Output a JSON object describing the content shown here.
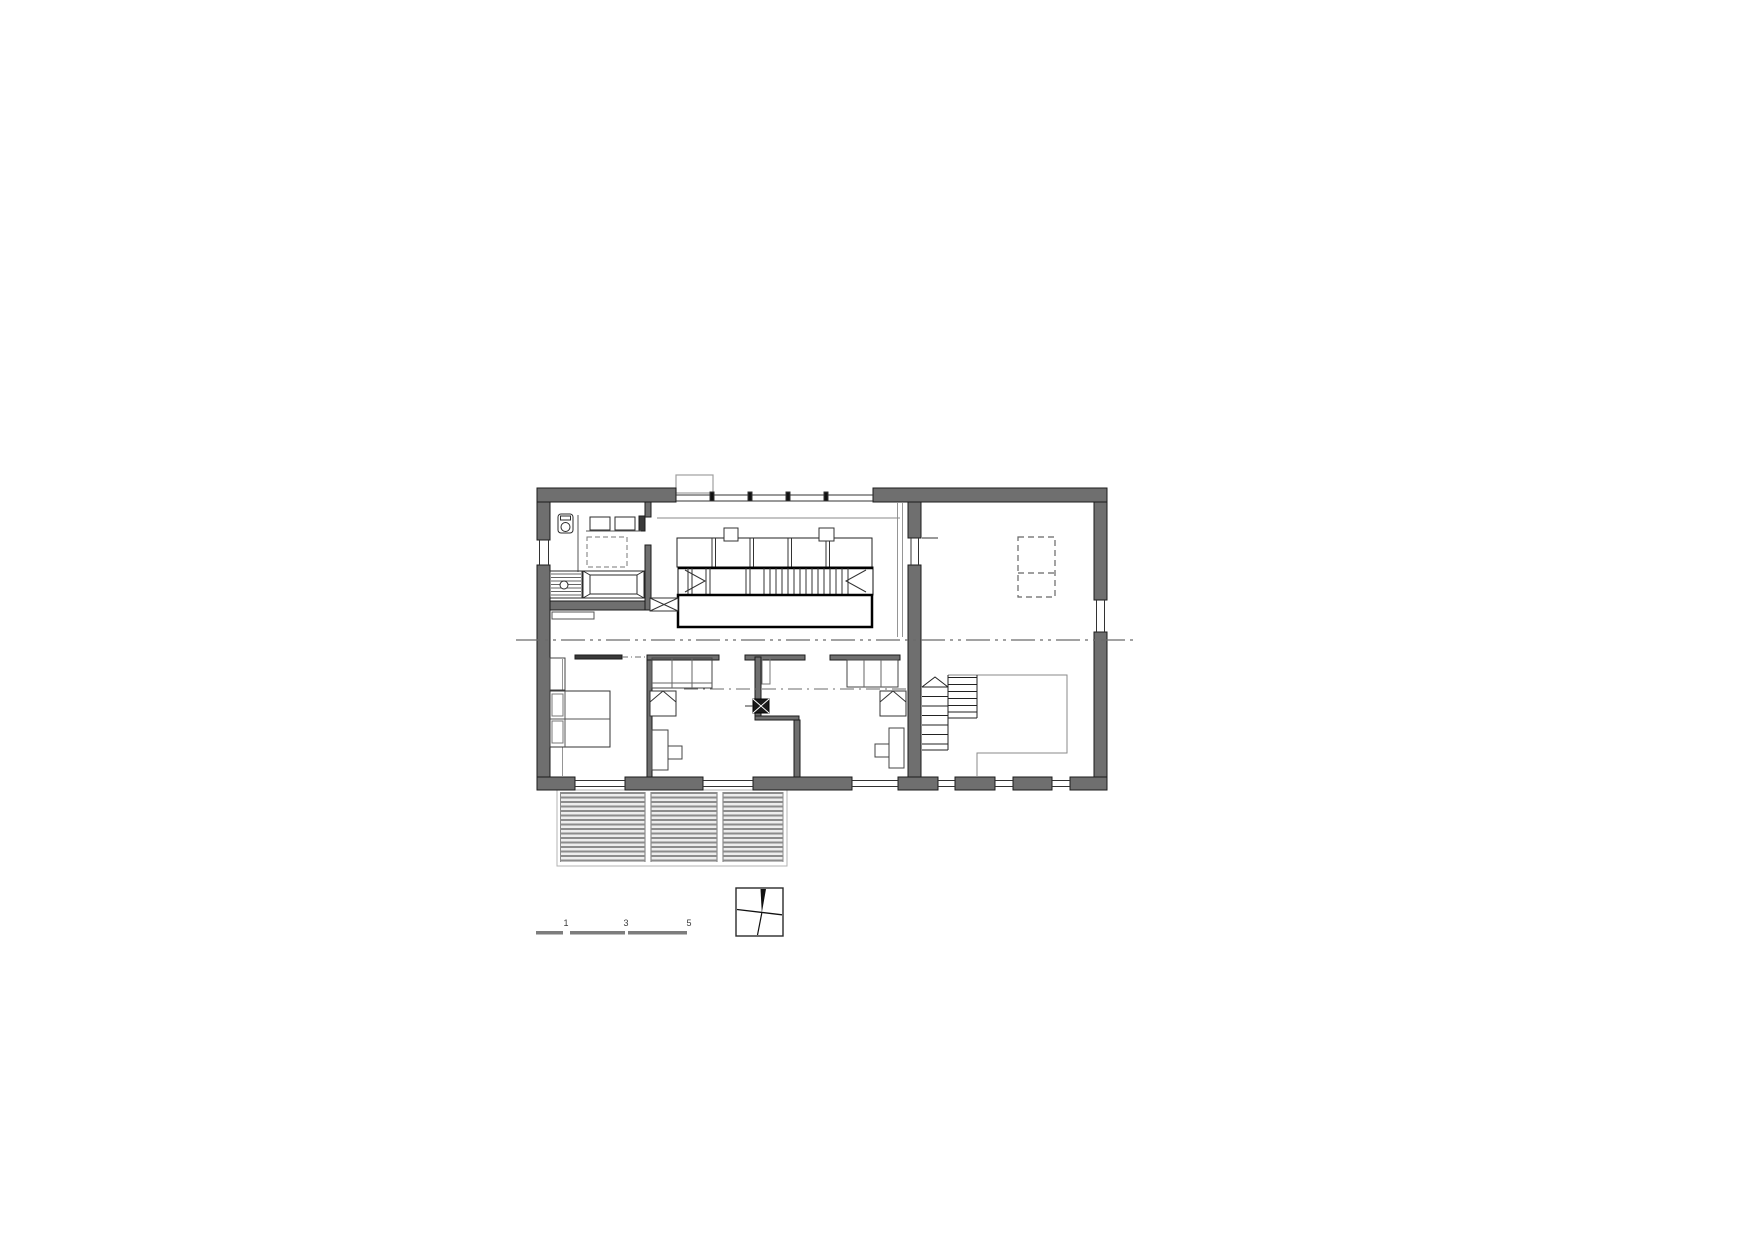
{
  "drawing": {
    "kind": "architectural-floor-plan",
    "scale_bar": {
      "labels": [
        "1",
        "3",
        "5"
      ]
    },
    "icons": {
      "north_arrow": "tilted-cross-with-north-wedge"
    },
    "colors": {
      "background": "#ffffff",
      "wall_fill": "#6f6f6f",
      "wall_outline": "#1b1b1b",
      "thin_line": "#333333",
      "light_line": "#8a8a8a",
      "deck_slat": "#8c8c8c",
      "scale_bar_segment": "#7d7d7d"
    }
  }
}
